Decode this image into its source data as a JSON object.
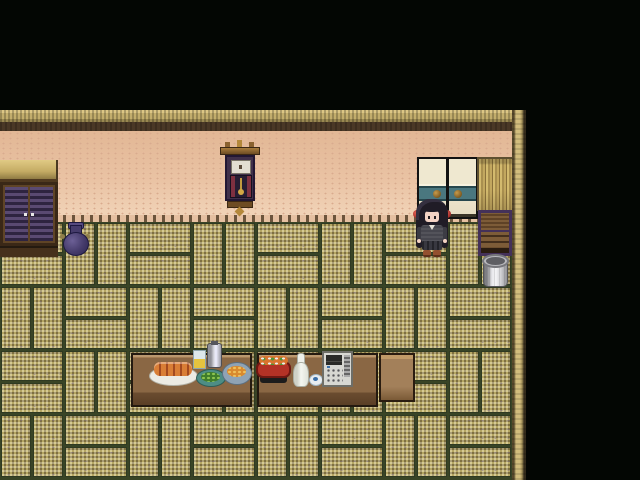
{
  "meta": {
    "app": "2D RPG game scene",
    "view": "Japanese-style tatami room interior, top-down RPG view",
    "resolution": "640x480"
  },
  "scene": {
    "room": {
      "label": "Tatami room",
      "wall": "Pink plaster wall with dithered texture and dashed baseboard",
      "floor": "Woven straw tatami mats laid in basketweave pattern with dark green seams",
      "frame": "Tan wooden beams along the top edge and right edge of the room",
      "outside": "Black void above and to the right of the room"
    },
    "objects": [
      {
        "id": "wardrobe",
        "label": "Wooden wardrobe with purple louvered doors"
      },
      {
        "id": "vase",
        "label": "Purple ceramic jug with side handles"
      },
      {
        "id": "wall-clock",
        "label": "Ornate pendulum wall clock with gold finials"
      },
      {
        "id": "sliding-doors",
        "label": "Sliding fusuma doors, cream with teal band and round bronze pulls"
      },
      {
        "id": "bamboo-screen",
        "label": "Bamboo screen wall panel"
      },
      {
        "id": "chest",
        "label": "Low wooden chest with purple frame"
      },
      {
        "id": "bucket",
        "label": "Metal bucket"
      },
      {
        "id": "character",
        "label": "Girl with long black hair, red hair ties and dark outfit"
      },
      {
        "id": "table-left",
        "label": "Low wooden dining table (left section)"
      },
      {
        "id": "table-right",
        "label": "Low wooden dining table (right section)"
      },
      {
        "id": "bench",
        "label": "Small light wooden bench beside table"
      },
      {
        "id": "skewer-plate",
        "label": "White plate of grilled skewers"
      },
      {
        "id": "glass",
        "label": "Glass of yellow drink"
      },
      {
        "id": "flask",
        "label": "Tall metal flask"
      },
      {
        "id": "salad-plate",
        "label": "Teal plate of green vegetables"
      },
      {
        "id": "noodle-bowl",
        "label": "Grey bowl of noodles"
      },
      {
        "id": "hot-pot",
        "label": "Red hot pot with vegetables on black stand"
      },
      {
        "id": "sake-bottle",
        "label": "White sake bottle"
      },
      {
        "id": "sake-cup",
        "label": "Small sake cup with blue center"
      },
      {
        "id": "appliance",
        "label": "Grey appliance with dark display, vents and button grid"
      }
    ],
    "palette": {
      "void": "#030603",
      "beam": "#cdb97b",
      "beam_shadow": "#4a3826",
      "wall_pink": "#eac3a4",
      "tatami_light": "#c9b96f",
      "tatami_dark": "#8d7d48",
      "tatami_seam": "#394426",
      "table_wood": "#8a6744",
      "door_cream": "#e9e2ca",
      "door_teal": "#4a777f",
      "pot_red": "#b33226",
      "hair_black": "#201c26",
      "ribbon_red": "#c03a3a",
      "bucket_grey": "#d9d9dc"
    },
    "floor_grid": {
      "tile_px": 32,
      "cols": 16,
      "rows": 8,
      "pattern": "basketweave"
    }
  }
}
